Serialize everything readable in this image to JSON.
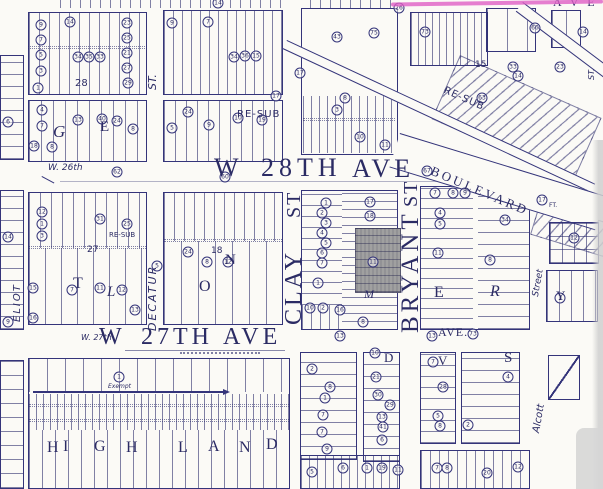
{
  "colors": {
    "ink": "#2b2b64",
    "ink_border": "#34347a",
    "lot_line": "rgba(46,46,110,0.6)",
    "paper": "#fbfaf6",
    "parcel_highlight": "#a0a0a0",
    "highlighter_magenta": "#e05fc6",
    "scan_gray": "#d4d4d4"
  },
  "highlighted_parcel": {
    "color": "#a0a0a0",
    "location": "west side of Bryant St between W 28th and W 27th Ave"
  },
  "streets": [
    {
      "t": "W",
      "x": 214,
      "y": 155,
      "fs": 26,
      "ff": "serif"
    },
    {
      "t": "28TH",
      "x": 261,
      "y": 155,
      "fs": 26,
      "sp": 5,
      "ff": "serif"
    },
    {
      "t": "AVE",
      "x": 352,
      "y": 156,
      "fs": 26,
      "sp": 4,
      "ff": "serif"
    },
    {
      "t": "W",
      "x": 99,
      "y": 325,
      "fs": 24,
      "ff": "serif"
    },
    {
      "t": "27TH",
      "x": 141,
      "y": 325,
      "fs": 24,
      "sp": 4,
      "ff": "serif"
    },
    {
      "t": "AVE",
      "x": 223,
      "y": 325,
      "fs": 24,
      "sp": 4,
      "ff": "serif"
    },
    {
      "t": "AVE.",
      "x": 438,
      "y": 326,
      "fs": 12,
      "sp": 1,
      "ff": "serif"
    },
    {
      "t": "CLAY",
      "x": 282,
      "y": 325,
      "fs": 24,
      "r": -90,
      "sp": 3,
      "ff": "serif"
    },
    {
      "t": "ST",
      "x": 284,
      "y": 218,
      "fs": 20,
      "r": -90,
      "sp": 2,
      "ff": "serif"
    },
    {
      "t": "BRYANT",
      "x": 398,
      "y": 333,
      "fs": 25,
      "r": -90,
      "sp": 4,
      "ff": "serif"
    },
    {
      "t": "ST",
      "x": 401,
      "y": 207,
      "fs": 20,
      "r": -90,
      "sp": 2,
      "ff": "serif"
    },
    {
      "t": "BOULEVARD",
      "x": 434,
      "y": 164,
      "fs": 13,
      "r": 23,
      "sp": 3,
      "ff": "serif"
    },
    {
      "t": "DECATUR",
      "x": 147,
      "y": 331,
      "fs": 11,
      "r": -90,
      "sp": 2,
      "st": "italic"
    },
    {
      "t": "ST.",
      "x": 147,
      "y": 90,
      "fs": 11,
      "r": -90,
      "st": "italic"
    },
    {
      "t": "ELIOT",
      "x": 13,
      "y": 322,
      "fs": 10,
      "r": -90,
      "sp": 2,
      "st": "italic"
    },
    {
      "t": "Street",
      "x": 532,
      "y": 296,
      "fs": 9,
      "r": -80,
      "st": "italic"
    },
    {
      "t": "Alcott",
      "x": 532,
      "y": 432,
      "fs": 10,
      "r": -80,
      "st": "italic"
    },
    {
      "t": "ST.",
      "x": 588,
      "y": 80,
      "fs": 8,
      "r": -90,
      "st": "italic"
    },
    {
      "t": "W. 26th",
      "x": 48,
      "y": 164,
      "fs": 9,
      "st": "italic"
    },
    {
      "t": "W. 27th",
      "x": 81,
      "y": 334,
      "fs": 8,
      "st": "italic"
    },
    {
      "t": "A V E",
      "x": 553,
      "y": -4,
      "fs": 12,
      "sp": 3,
      "ff": "serif"
    }
  ],
  "annotations": [
    {
      "t": "RE-SUB",
      "x": 237,
      "y": 110,
      "fs": 10,
      "sp": 1
    },
    {
      "t": "RE-SUB",
      "x": 446,
      "y": 86,
      "fs": 10,
      "r": 24,
      "sp": 1
    },
    {
      "t": "RE-SUB",
      "x": 109,
      "y": 232,
      "fs": 7
    },
    {
      "t": "28",
      "x": 75,
      "y": 79,
      "fs": 10
    },
    {
      "t": "27",
      "x": 87,
      "y": 246,
      "fs": 9
    },
    {
      "t": "15",
      "x": 475,
      "y": 61,
      "fs": 9
    },
    {
      "t": "18",
      "x": 211,
      "y": 247,
      "fs": 9
    },
    {
      "t": "FT.",
      "x": 549,
      "y": 203,
      "fs": 6
    },
    {
      "t": "Exempt",
      "x": 108,
      "y": 384,
      "fs": 6,
      "st": "italic"
    },
    {
      "t": "M",
      "x": 364,
      "y": 288,
      "fs": 12,
      "st": "italic",
      "ff": "serif"
    }
  ],
  "block_letters": [
    {
      "t": "G",
      "x": 53,
      "y": 123,
      "fs": 17,
      "st": "italic",
      "ff": "serif"
    },
    {
      "t": "E",
      "x": 100,
      "y": 120,
      "fs": 15,
      "ff": "serif"
    },
    {
      "t": "T",
      "x": 73,
      "y": 276,
      "fs": 16,
      "ff": "serif"
    },
    {
      "t": "L",
      "x": 107,
      "y": 285,
      "fs": 15,
      "st": "italic",
      "ff": "serif"
    },
    {
      "t": "O",
      "x": 199,
      "y": 279,
      "fs": 16,
      "ff": "serif"
    },
    {
      "t": "N",
      "x": 225,
      "y": 253,
      "fs": 15,
      "ff": "serif"
    },
    {
      "t": "E",
      "x": 434,
      "y": 285,
      "fs": 16,
      "ff": "serif"
    },
    {
      "t": "R",
      "x": 490,
      "y": 284,
      "fs": 16,
      "st": "italic",
      "ff": "serif"
    },
    {
      "t": "Y",
      "x": 556,
      "y": 289,
      "fs": 13,
      "ff": "serif"
    },
    {
      "t": "H",
      "x": 47,
      "y": 440,
      "fs": 16,
      "ff": "serif"
    },
    {
      "t": "I",
      "x": 63,
      "y": 439,
      "fs": 16,
      "ff": "serif"
    },
    {
      "t": "G",
      "x": 94,
      "y": 439,
      "fs": 16,
      "ff": "serif"
    },
    {
      "t": "H",
      "x": 126,
      "y": 440,
      "fs": 16,
      "ff": "serif"
    },
    {
      "t": "L",
      "x": 178,
      "y": 440,
      "fs": 16,
      "ff": "serif"
    },
    {
      "t": "A",
      "x": 208,
      "y": 439,
      "fs": 16,
      "ff": "serif"
    },
    {
      "t": "N",
      "x": 239,
      "y": 440,
      "fs": 16,
      "ff": "serif"
    },
    {
      "t": "D",
      "x": 266,
      "y": 437,
      "fs": 16,
      "ff": "serif"
    },
    {
      "t": "D",
      "x": 384,
      "y": 351,
      "fs": 13,
      "ff": "serif"
    },
    {
      "t": "V",
      "x": 438,
      "y": 354,
      "fs": 13,
      "ff": "serif"
    },
    {
      "t": "S",
      "x": 504,
      "y": 351,
      "fs": 15,
      "ff": "serif"
    }
  ],
  "lot_badges": [
    {
      "x": 41,
      "y": 25,
      "t": "9"
    },
    {
      "x": 41,
      "y": 40,
      "t": "7"
    },
    {
      "x": 41,
      "y": 55,
      "t": "5"
    },
    {
      "x": 41,
      "y": 71,
      "t": "3"
    },
    {
      "x": 38,
      "y": 88,
      "t": "1"
    },
    {
      "x": 70,
      "y": 22,
      "t": "14"
    },
    {
      "x": 78,
      "y": 57,
      "t": "34"
    },
    {
      "x": 89,
      "y": 57,
      "t": "35"
    },
    {
      "x": 100,
      "y": 57,
      "t": "33"
    },
    {
      "x": 127,
      "y": 23,
      "t": "23"
    },
    {
      "x": 127,
      "y": 38,
      "t": "25"
    },
    {
      "x": 127,
      "y": 53,
      "t": "21"
    },
    {
      "x": 127,
      "y": 68,
      "t": "27"
    },
    {
      "x": 128,
      "y": 83,
      "t": "29"
    },
    {
      "x": 42,
      "y": 110,
      "t": "4"
    },
    {
      "x": 42,
      "y": 126,
      "t": "7"
    },
    {
      "x": 34,
      "y": 146,
      "t": "18"
    },
    {
      "x": 52,
      "y": 147,
      "t": "8"
    },
    {
      "x": 78,
      "y": 120,
      "t": "13"
    },
    {
      "x": 102,
      "y": 119,
      "t": "40"
    },
    {
      "x": 117,
      "y": 121,
      "t": "24"
    },
    {
      "x": 133,
      "y": 129,
      "t": "8"
    },
    {
      "x": 172,
      "y": 23,
      "t": "9"
    },
    {
      "x": 208,
      "y": 22,
      "t": "7"
    },
    {
      "x": 234,
      "y": 57,
      "t": "34"
    },
    {
      "x": 245,
      "y": 56,
      "t": "36"
    },
    {
      "x": 256,
      "y": 56,
      "t": "15"
    },
    {
      "x": 188,
      "y": 112,
      "t": "24"
    },
    {
      "x": 172,
      "y": 128,
      "t": "5"
    },
    {
      "x": 209,
      "y": 125,
      "t": "9"
    },
    {
      "x": 238,
      "y": 118,
      "t": "10"
    },
    {
      "x": 262,
      "y": 120,
      "t": "19"
    },
    {
      "x": 276,
      "y": 96,
      "t": "17"
    },
    {
      "x": 218,
      "y": 3,
      "t": "14"
    },
    {
      "x": 399,
      "y": 8,
      "t": "26"
    },
    {
      "x": 300,
      "y": 73,
      "t": "17"
    },
    {
      "x": 337,
      "y": 37,
      "t": "43"
    },
    {
      "x": 374,
      "y": 33,
      "t": "75"
    },
    {
      "x": 345,
      "y": 98,
      "t": "8"
    },
    {
      "x": 337,
      "y": 110,
      "t": "3"
    },
    {
      "x": 360,
      "y": 137,
      "t": "10"
    },
    {
      "x": 385,
      "y": 145,
      "t": "11"
    },
    {
      "x": 425,
      "y": 32,
      "t": "73"
    },
    {
      "x": 513,
      "y": 67,
      "t": "33"
    },
    {
      "x": 518,
      "y": 76,
      "t": "14"
    },
    {
      "x": 482,
      "y": 98,
      "t": "63"
    },
    {
      "x": 535,
      "y": 28,
      "t": "60"
    },
    {
      "x": 583,
      "y": 32,
      "t": "14"
    },
    {
      "x": 560,
      "y": 67,
      "t": "23"
    },
    {
      "x": 427,
      "y": 171,
      "t": "67"
    },
    {
      "x": 542,
      "y": 200,
      "t": "17"
    },
    {
      "x": 117,
      "y": 172,
      "t": "62"
    },
    {
      "x": 225,
      "y": 177,
      "t": "60"
    },
    {
      "x": 8,
      "y": 122,
      "t": "6"
    },
    {
      "x": 8,
      "y": 237,
      "t": "14"
    },
    {
      "x": 8,
      "y": 322,
      "t": "9"
    },
    {
      "x": 42,
      "y": 212,
      "t": "12"
    },
    {
      "x": 42,
      "y": 224,
      "t": "1"
    },
    {
      "x": 42,
      "y": 236,
      "t": "3"
    },
    {
      "x": 100,
      "y": 219,
      "t": "31"
    },
    {
      "x": 127,
      "y": 224,
      "t": "25"
    },
    {
      "x": 33,
      "y": 288,
      "t": "15"
    },
    {
      "x": 72,
      "y": 290,
      "t": "7"
    },
    {
      "x": 100,
      "y": 288,
      "t": "11"
    },
    {
      "x": 122,
      "y": 290,
      "t": "12"
    },
    {
      "x": 135,
      "y": 310,
      "t": "13"
    },
    {
      "x": 33,
      "y": 318,
      "t": "16"
    },
    {
      "x": 188,
      "y": 252,
      "t": "24"
    },
    {
      "x": 207,
      "y": 262,
      "t": "8"
    },
    {
      "x": 228,
      "y": 262,
      "t": "12"
    },
    {
      "x": 157,
      "y": 266,
      "t": "5"
    },
    {
      "x": 326,
      "y": 203,
      "t": "1"
    },
    {
      "x": 322,
      "y": 213,
      "t": "2"
    },
    {
      "x": 326,
      "y": 223,
      "t": "3"
    },
    {
      "x": 322,
      "y": 233,
      "t": "4"
    },
    {
      "x": 326,
      "y": 243,
      "t": "5"
    },
    {
      "x": 322,
      "y": 253,
      "t": "6"
    },
    {
      "x": 322,
      "y": 263,
      "t": "7"
    },
    {
      "x": 318,
      "y": 283,
      "t": "1"
    },
    {
      "x": 310,
      "y": 308,
      "t": "10"
    },
    {
      "x": 323,
      "y": 308,
      "t": "2"
    },
    {
      "x": 340,
      "y": 310,
      "t": "16"
    },
    {
      "x": 370,
      "y": 202,
      "t": "17"
    },
    {
      "x": 370,
      "y": 216,
      "t": "18"
    },
    {
      "x": 373,
      "y": 262,
      "t": "11"
    },
    {
      "x": 363,
      "y": 322,
      "t": "8"
    },
    {
      "x": 340,
      "y": 336,
      "t": "13"
    },
    {
      "x": 435,
      "y": 193,
      "t": "7"
    },
    {
      "x": 453,
      "y": 193,
      "t": "8"
    },
    {
      "x": 465,
      "y": 193,
      "t": "9"
    },
    {
      "x": 440,
      "y": 213,
      "t": "4"
    },
    {
      "x": 440,
      "y": 224,
      "t": "5"
    },
    {
      "x": 438,
      "y": 253,
      "t": "11"
    },
    {
      "x": 505,
      "y": 220,
      "t": "34"
    },
    {
      "x": 490,
      "y": 260,
      "t": "8"
    },
    {
      "x": 473,
      "y": 334,
      "t": "73"
    },
    {
      "x": 432,
      "y": 336,
      "t": "13"
    },
    {
      "x": 574,
      "y": 238,
      "t": "12"
    },
    {
      "x": 560,
      "y": 298,
      "t": "1"
    },
    {
      "x": 119,
      "y": 377,
      "t": "1"
    },
    {
      "x": 312,
      "y": 369,
      "t": "2"
    },
    {
      "x": 330,
      "y": 387,
      "t": "8"
    },
    {
      "x": 325,
      "y": 398,
      "t": "1"
    },
    {
      "x": 323,
      "y": 415,
      "t": "7"
    },
    {
      "x": 322,
      "y": 432,
      "t": "7"
    },
    {
      "x": 327,
      "y": 449,
      "t": "9"
    },
    {
      "x": 375,
      "y": 353,
      "t": "10"
    },
    {
      "x": 376,
      "y": 377,
      "t": "21"
    },
    {
      "x": 378,
      "y": 395,
      "t": "30"
    },
    {
      "x": 390,
      "y": 405,
      "t": "29"
    },
    {
      "x": 382,
      "y": 417,
      "t": "13"
    },
    {
      "x": 383,
      "y": 427,
      "t": "41"
    },
    {
      "x": 382,
      "y": 440,
      "t": "6"
    },
    {
      "x": 433,
      "y": 362,
      "t": "7"
    },
    {
      "x": 443,
      "y": 387,
      "t": "28"
    },
    {
      "x": 438,
      "y": 416,
      "t": "5"
    },
    {
      "x": 440,
      "y": 426,
      "t": "8"
    },
    {
      "x": 468,
      "y": 425,
      "t": "2"
    },
    {
      "x": 508,
      "y": 377,
      "t": "4"
    },
    {
      "x": 312,
      "y": 472,
      "t": "5"
    },
    {
      "x": 343,
      "y": 468,
      "t": "6"
    },
    {
      "x": 367,
      "y": 468,
      "t": "1"
    },
    {
      "x": 382,
      "y": 468,
      "t": "19"
    },
    {
      "x": 398,
      "y": 470,
      "t": "11"
    },
    {
      "x": 437,
      "y": 468,
      "t": "7"
    },
    {
      "x": 447,
      "y": 468,
      "t": "8"
    },
    {
      "x": 487,
      "y": 473,
      "t": "20"
    },
    {
      "x": 518,
      "y": 467,
      "t": "12"
    }
  ]
}
